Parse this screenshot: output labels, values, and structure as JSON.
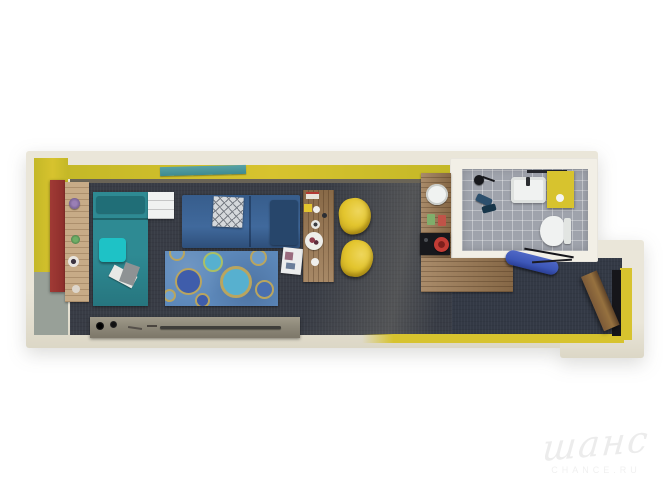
{
  "watermark": {
    "brand": "шанс",
    "domain": "CHANCE.RU"
  },
  "palette": {
    "bg": "#ffffff",
    "wall": "#eae6d9",
    "wall-shade": "#dcd7c6",
    "wall-bright": "#f2efe6",
    "yellow": "#c4b827",
    "yellow-bright": "#d7c32e",
    "gray-wall": "#98a098",
    "red-panel": "#a03a35",
    "wood": "#9b7851",
    "wood-light": "#c7ab87",
    "wood-dark": "#7c5a38",
    "floor": "#383c45",
    "floor-entry": "#333945",
    "tile": "#9fa3ac",
    "teal": "#2e8a93",
    "teal-dark": "#206e77",
    "cyan": "#1ec2c6",
    "navy": "#375d8c",
    "navy-dark": "#27466b",
    "rug": "#5c88ba",
    "rug-ring": "#b9a55f",
    "rug-deep": "#3f5dab",
    "rug-light": "#57b0cf",
    "chair": "#e3c52e",
    "sideboard": "#8f8a7b",
    "white": "#f0f2f1",
    "black": "#17181c",
    "bench-blue": "#3d57b8",
    "pot-red": "#c23c35",
    "window-teal": "#3f8a8f",
    "watermark": "#ececec"
  }
}
